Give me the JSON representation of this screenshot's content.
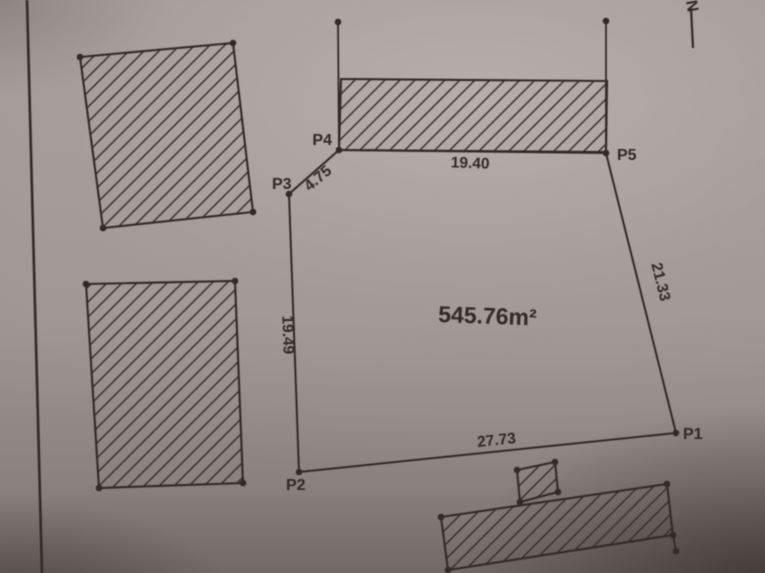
{
  "drawing": {
    "ink_color": "#312a26",
    "north_label": "N",
    "area_label": "545.76m²",
    "area_x": 438,
    "area_y": 322,
    "area_rot": 2,
    "parcel": {
      "vertices": [
        {
          "id": "P1",
          "x": 676,
          "y": 433,
          "label_x": 683,
          "label_y": 439,
          "anchor": "start"
        },
        {
          "id": "P2",
          "x": 299,
          "y": 472,
          "label_x": 286,
          "label_y": 490,
          "anchor": "start"
        },
        {
          "id": "P3",
          "x": 289,
          "y": 194,
          "label_x": 272,
          "label_y": 189,
          "anchor": "start"
        },
        {
          "id": "P4",
          "x": 339,
          "y": 150,
          "label_x": 332,
          "label_y": 145,
          "anchor": "end"
        },
        {
          "id": "P5",
          "x": 606,
          "y": 153,
          "label_x": 617,
          "label_y": 160,
          "anchor": "start"
        }
      ],
      "edges": [
        {
          "from": "P4",
          "to": "P5",
          "length": "19.40",
          "lx": 470,
          "ly": 168,
          "rot": 2
        },
        {
          "from": "P5",
          "to": "P1",
          "length": "21.33",
          "lx": 656,
          "ly": 283,
          "rot": 76
        },
        {
          "from": "P1",
          "to": "P2",
          "length": "27.73",
          "lx": 497,
          "ly": 445,
          "rot": -6
        },
        {
          "from": "P2",
          "to": "P3",
          "length": "19.49",
          "lx": 283,
          "ly": 335,
          "rot": 88
        },
        {
          "from": "P3",
          "to": "P4",
          "length": "4.75",
          "lx": 321,
          "ly": 182,
          "rot": -40
        }
      ]
    },
    "structures": [
      {
        "name": "building-top-left",
        "points": [
          [
            80,
            57
          ],
          [
            233,
            43
          ],
          [
            253,
            212
          ],
          [
            103,
            228
          ]
        ],
        "corner_dots": true
      },
      {
        "name": "building-mid-left",
        "points": [
          [
            86,
            284
          ],
          [
            235,
            281
          ],
          [
            243,
            483
          ],
          [
            99,
            488
          ]
        ],
        "corner_dots": true
      },
      {
        "name": "building-top-strip",
        "points": [
          [
            341,
            79
          ],
          [
            607,
            81
          ],
          [
            606,
            152
          ],
          [
            339,
            150
          ]
        ],
        "corner_dots": false
      },
      {
        "name": "building-small-square",
        "points": [
          [
            517,
            470
          ],
          [
            555,
            462
          ],
          [
            558,
            492
          ],
          [
            520,
            502
          ]
        ],
        "corner_dots": true
      },
      {
        "name": "building-bottom",
        "points": [
          [
            441,
            517
          ],
          [
            667,
            484
          ],
          [
            673,
            535
          ],
          [
            448,
            570
          ]
        ],
        "corner_dots": true
      }
    ],
    "segments": [
      {
        "name": "tie-line-left",
        "x1": 339,
        "y1": 150,
        "x2": 338,
        "y2": 22,
        "dot_end": true,
        "w": 1.8
      },
      {
        "name": "tie-line-right",
        "x1": 606,
        "y1": 152,
        "x2": 606,
        "y2": 21,
        "dot_end": true,
        "w": 1.8
      },
      {
        "name": "stub-bottom-right",
        "x1": 673,
        "y1": 535,
        "x2": 676,
        "y2": 551,
        "dot_end": true,
        "w": 1.8
      },
      {
        "name": "north-arrow-line",
        "x1": 691,
        "y1": 8,
        "x2": 693,
        "y2": 48,
        "dot_end": false,
        "w": 2.2
      },
      {
        "name": "sheet-border-line",
        "x1": 27,
        "y1": 0,
        "x2": 42,
        "y2": 573,
        "dot_end": false,
        "w": 2.6
      }
    ],
    "north_x": 687,
    "north_y": 7,
    "north_rot": 80
  }
}
